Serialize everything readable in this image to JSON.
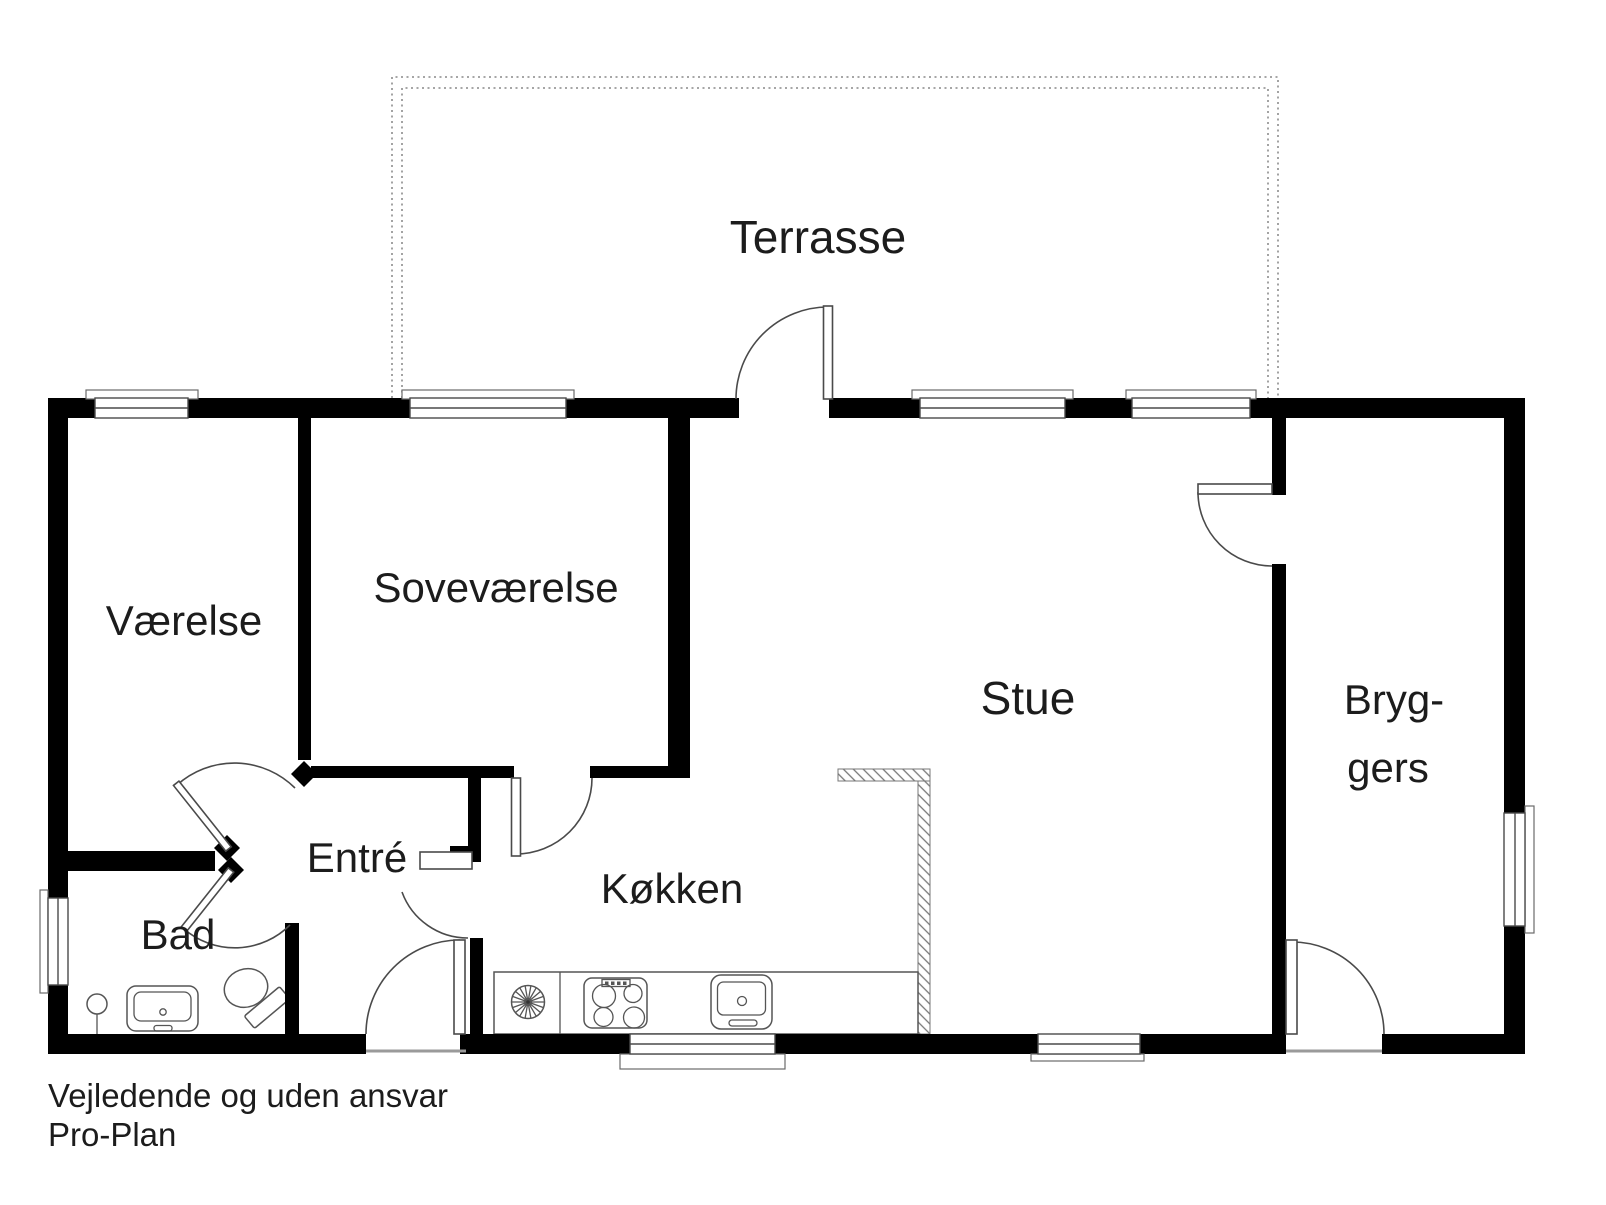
{
  "floor_plan": {
    "rooms": [
      {
        "name": "terrasse",
        "label": "Terrasse"
      },
      {
        "name": "vaerelse",
        "label": "Værelse"
      },
      {
        "name": "sovevaerelse",
        "label": "Soveværelse"
      },
      {
        "name": "stue",
        "label": "Stue"
      },
      {
        "name": "bryggers",
        "label_line_1": "Bryg-",
        "label_line_2": "gers"
      },
      {
        "name": "entre",
        "label": "Entré"
      },
      {
        "name": "bad",
        "label": "Bad"
      },
      {
        "name": "koekken",
        "label": "Køkken"
      }
    ],
    "disclaimer": "Vejledende og uden ansvar",
    "credit": "Pro-Plan",
    "colors": {
      "wall": "#000000",
      "thin_line": "#4a4a4a",
      "fixture_line": "#555555",
      "dotted_outline": "#999999",
      "hatch_line": "#777777",
      "text": "#1c1c1c",
      "background": "#ffffff"
    }
  }
}
